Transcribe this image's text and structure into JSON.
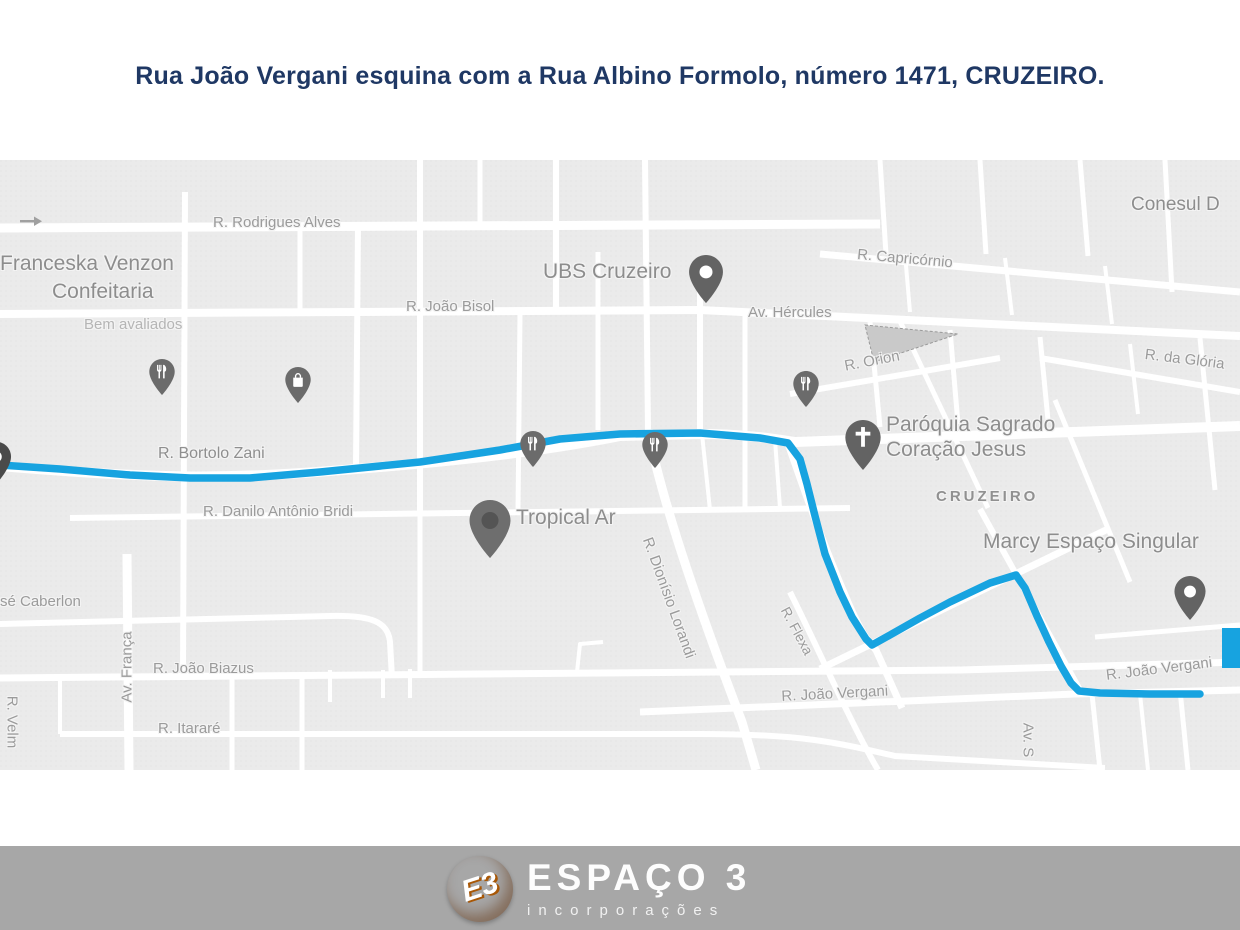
{
  "title": "Rua João Vergani esquina com a Rua Albino Formolo, número 1471, CRUZEIRO.",
  "colors": {
    "title_text": "#1f3864",
    "route_blue": "#17a3e0",
    "map_background": "#ebebeb",
    "street_white": "#ffffff",
    "street_label_gray": "#9b9b9b",
    "poi_label_gray": "#8d8d8d",
    "pin_gray": "#6b6b6b",
    "footer_gray": "#a7a7a7",
    "logo_orange": "#e8820c"
  },
  "map": {
    "neighborhood": "CRUZEIRO",
    "streets": {
      "rodrigues_alves": "R. Rodrigues Alves",
      "joao_bisol": "R. João Bisol",
      "av_hercules": "Av. Hércules",
      "capricornio": "R. Capricórnio",
      "da_gloria": "R. da Glória",
      "orion": "R. Orion",
      "bortolo_zani": "R. Bortolo Zani",
      "danilo_bridi": "R. Danilo Antônio Bridi",
      "dionisio_lorandi": "R. Dionísio Lorandi",
      "flexa": "R. Flexa",
      "joao_biazus": "R. João Biazus",
      "itarare": "R. Itararé",
      "av_franca": "Av. França",
      "velm": "R. Velm",
      "joao_vergani_left": "R. João Vergani",
      "joao_vergani_right": "R. João Vergani",
      "av_s": "Av. S",
      "caberlon": "sé Caberlon"
    },
    "pois": {
      "franceska_line1": "Franceska Venzon",
      "franceska_line2": "Confeitaria",
      "franceska_sub": "Bem avaliados",
      "ubs": "UBS Cruzeiro",
      "conesul": "Conesul D",
      "tropical": "Tropical Ar",
      "paroquia_line1": "Paróquia Sagrado",
      "paroquia_line2": "Coração Jesus",
      "marcy": "Marcy Espaço Singular"
    },
    "route": {
      "color": "#17a3e0",
      "points": [
        [
          0,
          305
        ],
        [
          60,
          309
        ],
        [
          130,
          315
        ],
        [
          190,
          318
        ],
        [
          250,
          318
        ],
        [
          320,
          312
        ],
        [
          420,
          302
        ],
        [
          500,
          290
        ],
        [
          560,
          279
        ],
        [
          620,
          274
        ],
        [
          700,
          273
        ],
        [
          760,
          278
        ],
        [
          788,
          283
        ],
        [
          800,
          299
        ],
        [
          807,
          324
        ],
        [
          815,
          356
        ],
        [
          825,
          394
        ],
        [
          840,
          432
        ],
        [
          852,
          457
        ],
        [
          866,
          479
        ],
        [
          872,
          485
        ],
        [
          890,
          475
        ],
        [
          920,
          458
        ],
        [
          950,
          442
        ],
        [
          990,
          423
        ],
        [
          1016,
          415
        ],
        [
          1025,
          428
        ],
        [
          1037,
          456
        ],
        [
          1049,
          482
        ],
        [
          1061,
          506
        ],
        [
          1071,
          523
        ],
        [
          1079,
          531
        ],
        [
          1100,
          533
        ],
        [
          1150,
          534
        ],
        [
          1200,
          534
        ]
      ]
    }
  },
  "footer": {
    "brand": "ESPAÇO 3",
    "tagline": "incorporações",
    "monogram": "E3"
  }
}
